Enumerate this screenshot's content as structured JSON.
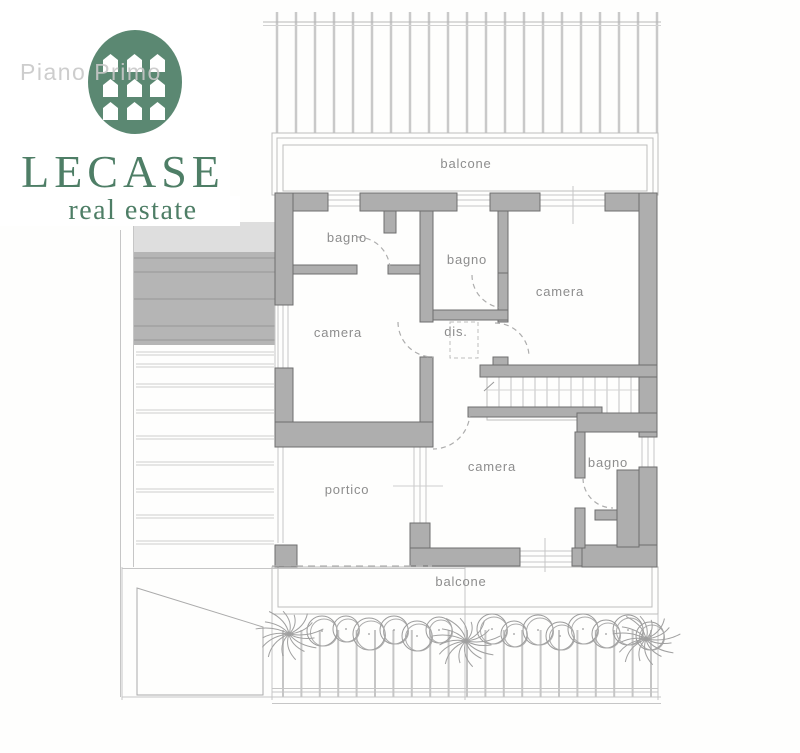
{
  "watermark": {
    "label": "Piano Primo"
  },
  "logo": {
    "brand": "LECASE",
    "tagline": "real estate",
    "symbol": "green-oval-nine-houses"
  },
  "plan": {
    "labels": {
      "balcone_top": "balcone",
      "bagno_top_left": "bagno",
      "bagno_top_mid": "bagno",
      "camera_right": "camera",
      "camera_left": "camera",
      "dis": "dis.",
      "camera_bottom": "camera",
      "bagno_bottom_right": "bagno",
      "portico": "portico",
      "balcone_bottom": "balcone"
    },
    "colors": {
      "wall_fill": "#aeaeae",
      "wall_stroke": "#6e6e6e",
      "thin_line": "#c6c6c6",
      "label_text": "#8d8d8d",
      "logo_green": "#5b8872",
      "brand_green": "#4e7e66",
      "watermark_gray": "#c8c8c8"
    }
  }
}
